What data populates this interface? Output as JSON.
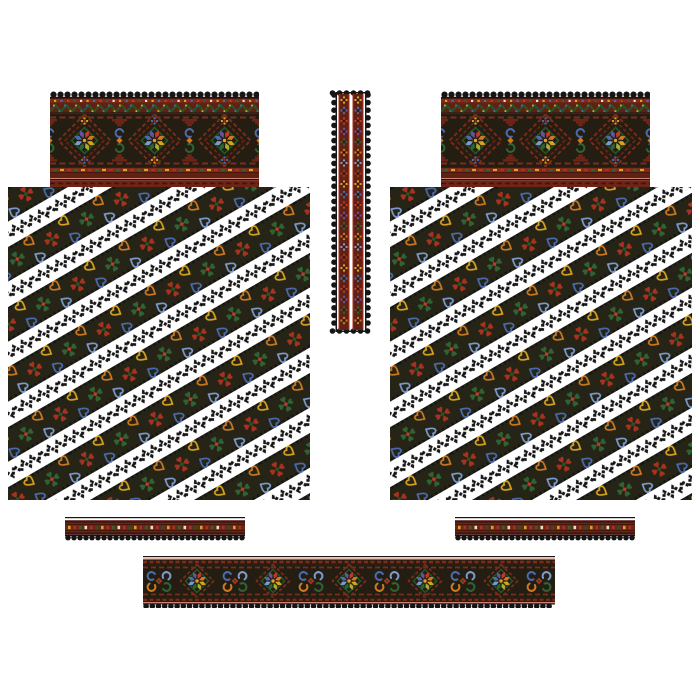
{
  "canvas": {
    "width": 700,
    "height": 700,
    "background": "#ffffff"
  },
  "palette": {
    "white": "#ffffff",
    "black": "#151515",
    "field_dark": "#262416",
    "band_dark": "#241e12",
    "maroon": "#7d2b1c",
    "dark_red": "#5f2114",
    "deep_red": "#6e2417",
    "red": "#a8321f",
    "bright_red": "#c03a28",
    "orange": "#cd7a22",
    "gold": "#d9a31f",
    "cream": "#e8dfc5",
    "yellow_green": "#a9ad2e",
    "green": "#2e6434",
    "dark_green": "#255427",
    "blue": "#4a6cae",
    "light_blue": "#7c9cd0",
    "purple": "#6c4fa4",
    "pink": "#cc8573"
  },
  "star_petals": [
    "#c03a28",
    "#cd7a22",
    "#d9a31f",
    "#a9ad2e",
    "#2e6434",
    "#7c9cd0",
    "#4a6cae",
    "#6c4fa4"
  ],
  "stripe": {
    "angle": -30,
    "tile_w": 80,
    "tile_h": 52,
    "dark_band_h": 30,
    "rosette_colors": [
      "#a8321f",
      "#2e6434"
    ],
    "heart_colors": [
      "#d9a31f",
      "#4a6cae",
      "#cd7a22",
      "#7c9cd0"
    ]
  },
  "cycles": {
    "band_dots": [
      "#d9a31f",
      "#4a6cae",
      "#c03a28",
      "#2e6434",
      "#e8dfc5"
    ],
    "band_dashes": [
      "#2e6434",
      "#d9a31f",
      "#a8321f"
    ],
    "cuff_dashes": [
      "#d9a31f",
      "#a8321f",
      "#2e6434",
      "#e8dfc5",
      "#a8321f",
      "#255427"
    ],
    "strip_rosettes": [
      "#d9a31f",
      "#4a6cae",
      "#c03a28",
      "#6c4fa4",
      "#2e6434",
      "#cd7a22",
      "#7c9cd0",
      "#a8321f"
    ]
  },
  "pieces": [
    {
      "id": "left-shoulder-band",
      "type": "shoulder-band",
      "x": 50,
      "y": 90,
      "w": 209,
      "h": 97,
      "star_cx": [
        34.5,
        104.5,
        174.5
      ],
      "scroll_cx": [
        -0.5,
        69.5,
        139.5,
        209.5
      ]
    },
    {
      "id": "right-shoulder-band",
      "type": "shoulder-band",
      "x": 441,
      "y": 90,
      "w": 209,
      "h": 97,
      "star_cx": [
        34.5,
        104.5,
        174.5
      ],
      "scroll_cx": [
        -0.5,
        69.5,
        139.5,
        209.5
      ]
    },
    {
      "id": "neck-strip",
      "type": "vertical-strip",
      "x": 329,
      "y": 88,
      "w": 44,
      "h": 248
    },
    {
      "id": "left-sleeve-panel",
      "type": "sleeve-panel",
      "x": 8,
      "y": 187,
      "w": 302,
      "h": 313
    },
    {
      "id": "right-sleeve-panel",
      "type": "sleeve-panel",
      "x": 390,
      "y": 187,
      "w": 302,
      "h": 313
    },
    {
      "id": "left-cuff-strip",
      "type": "cuff-strip",
      "x": 65,
      "y": 517,
      "w": 180,
      "h": 24
    },
    {
      "id": "right-cuff-strip",
      "type": "cuff-strip",
      "x": 455,
      "y": 517,
      "w": 180,
      "h": 24
    },
    {
      "id": "collar-band",
      "type": "collar-band",
      "x": 143,
      "y": 556,
      "w": 412,
      "h": 52,
      "star_cx": [
        54,
        130,
        206,
        282,
        358
      ],
      "scroll_cx": [
        16,
        92,
        168,
        244,
        320,
        396
      ]
    }
  ]
}
